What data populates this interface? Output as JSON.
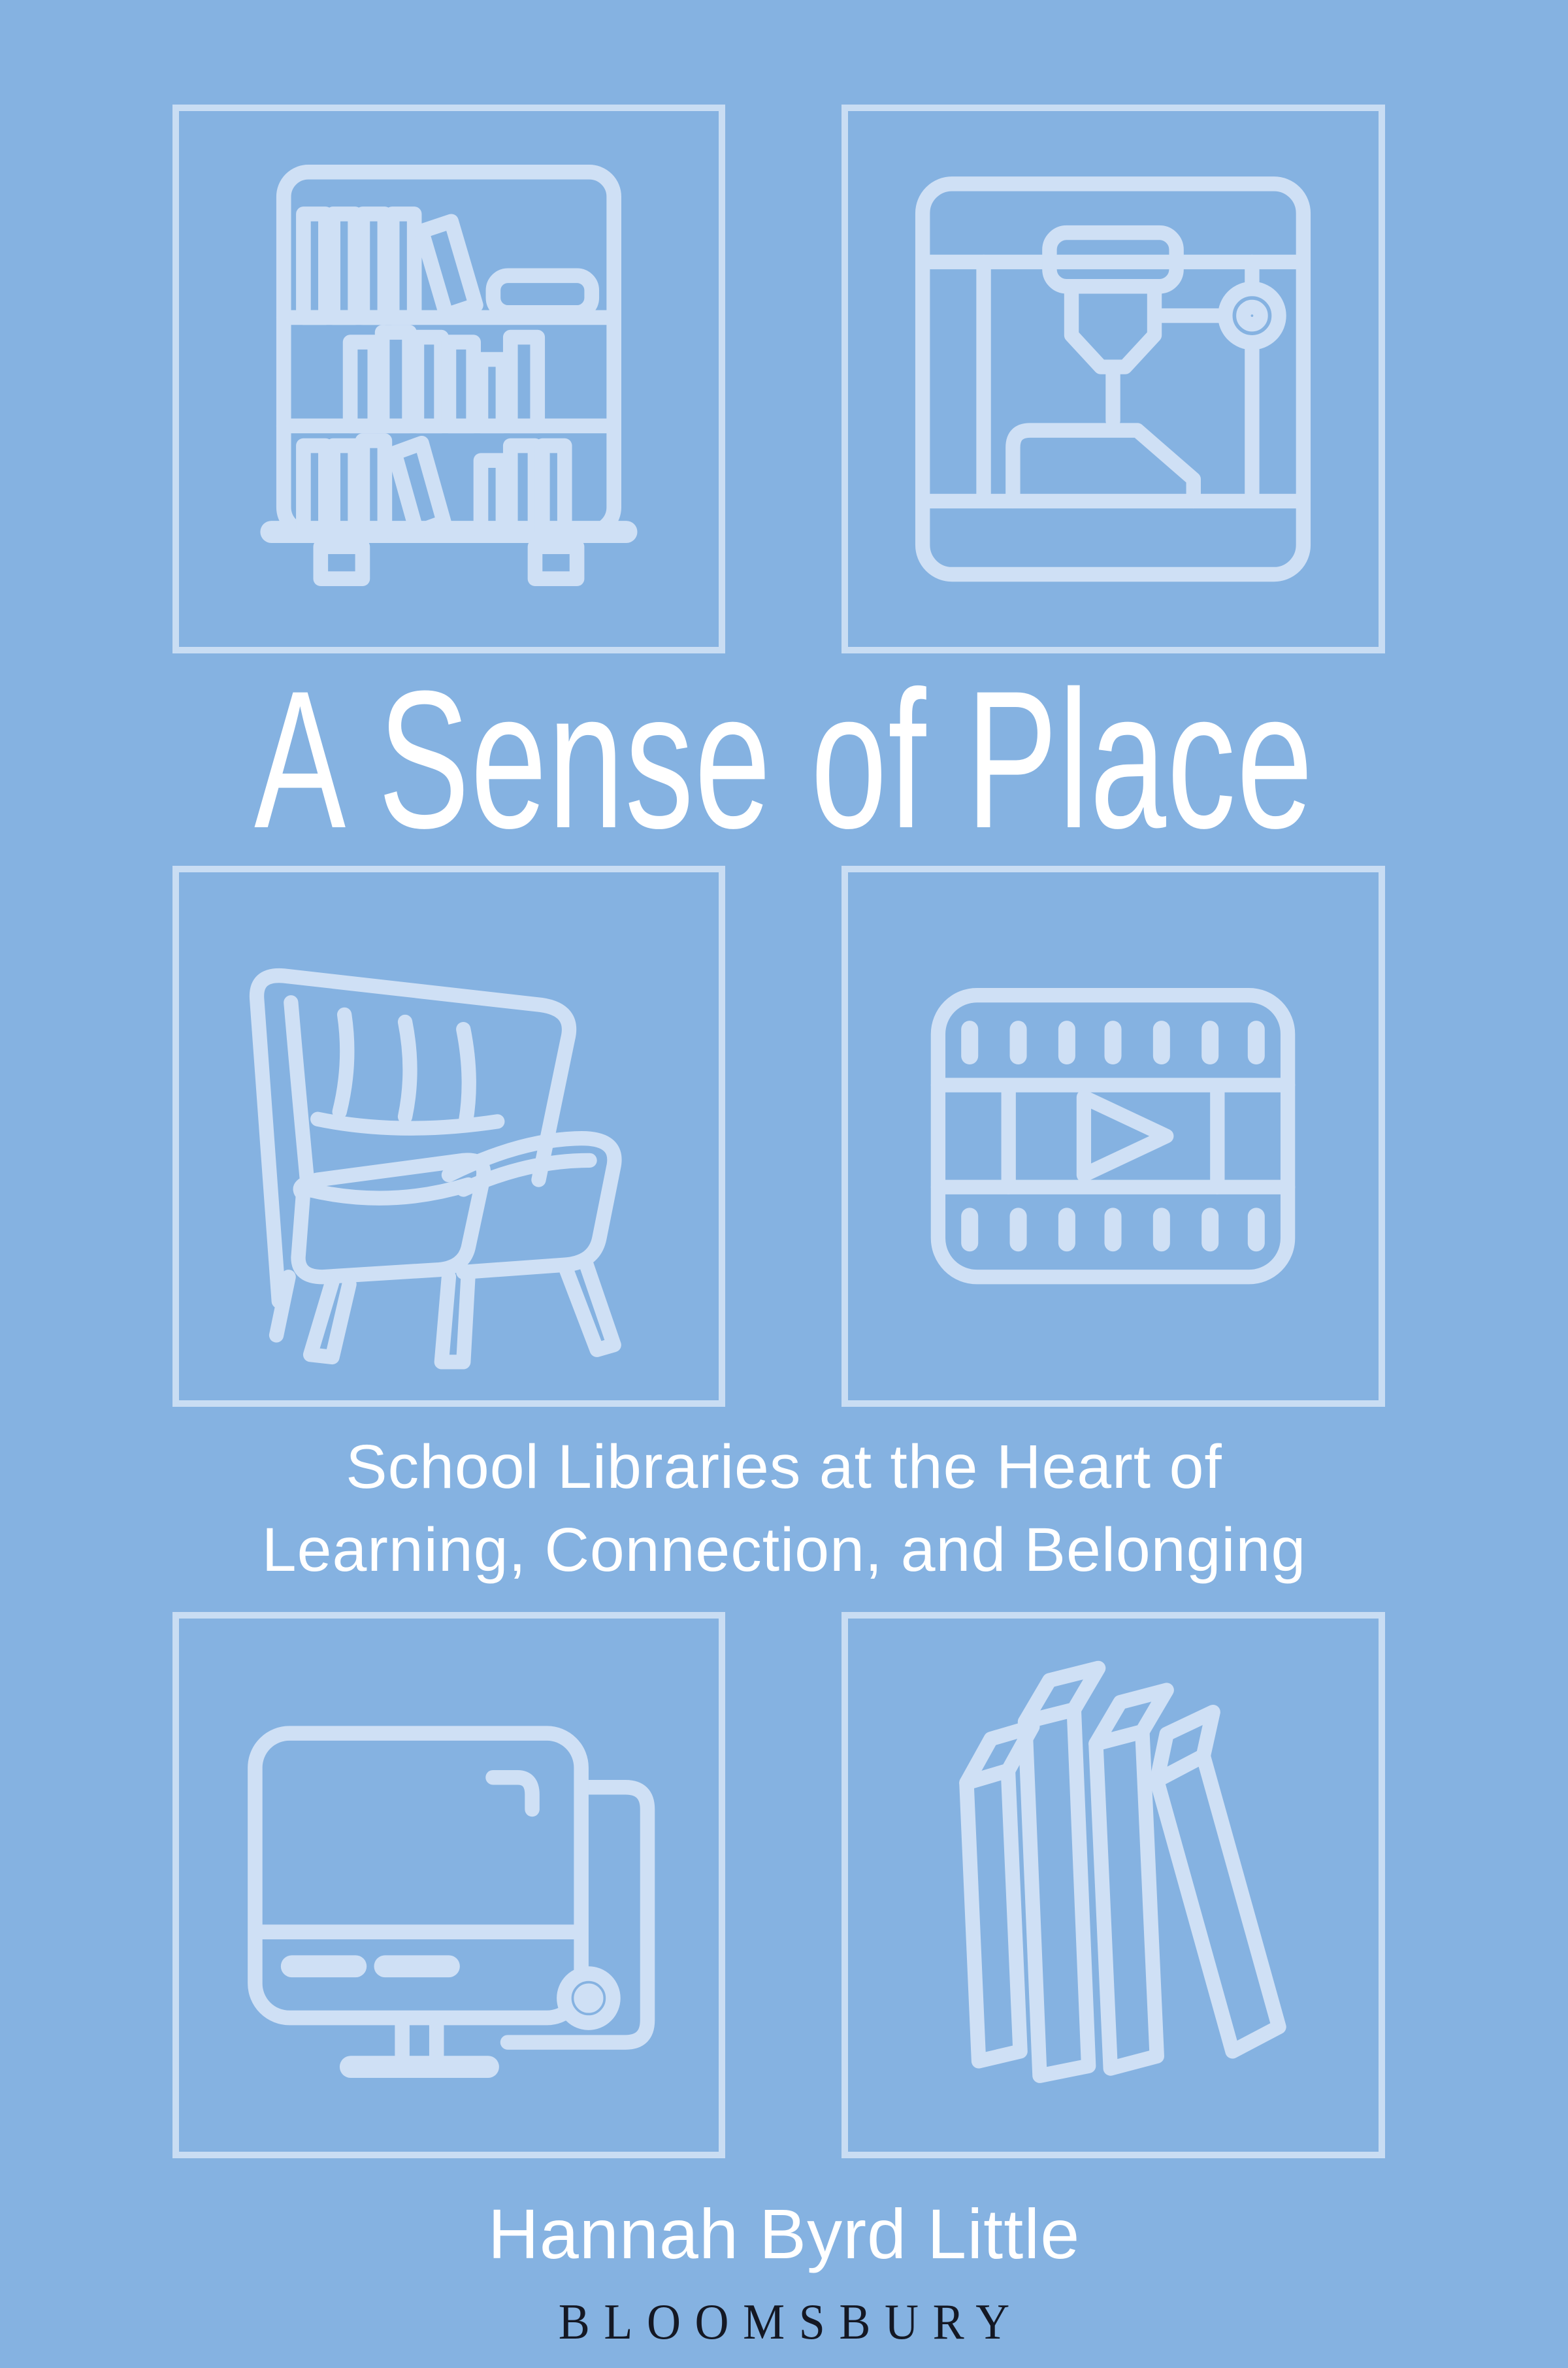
{
  "cover": {
    "title": "A Sense of Place",
    "subtitle_line1": "School Libraries at the Heart of",
    "subtitle_line2": "Learning, Connection, and Belonging",
    "author": "Hannah Byrd Little",
    "publisher": "BLOOMSBURY",
    "colors": {
      "background": "#85b2e1",
      "icon_line": "#cfe0f5",
      "box_border": "#c9ddf3",
      "title_text": "#ffffff",
      "publisher_text": "#141824"
    },
    "icons": [
      {
        "name": "bookshelf-icon",
        "depicts": "bookshelf with books",
        "position": "top-left"
      },
      {
        "name": "3d-printer-icon",
        "depicts": "3D printer printing an object",
        "position": "top-right"
      },
      {
        "name": "armchair-icon",
        "depicts": "reading armchair",
        "position": "middle-left"
      },
      {
        "name": "film-strip-icon",
        "depicts": "film strip with play button",
        "position": "middle-right"
      },
      {
        "name": "desktop-computer-icon",
        "depicts": "desktop computer and tower",
        "position": "bottom-left"
      },
      {
        "name": "books-icon",
        "depicts": "row of standing books",
        "position": "bottom-right"
      }
    ]
  }
}
